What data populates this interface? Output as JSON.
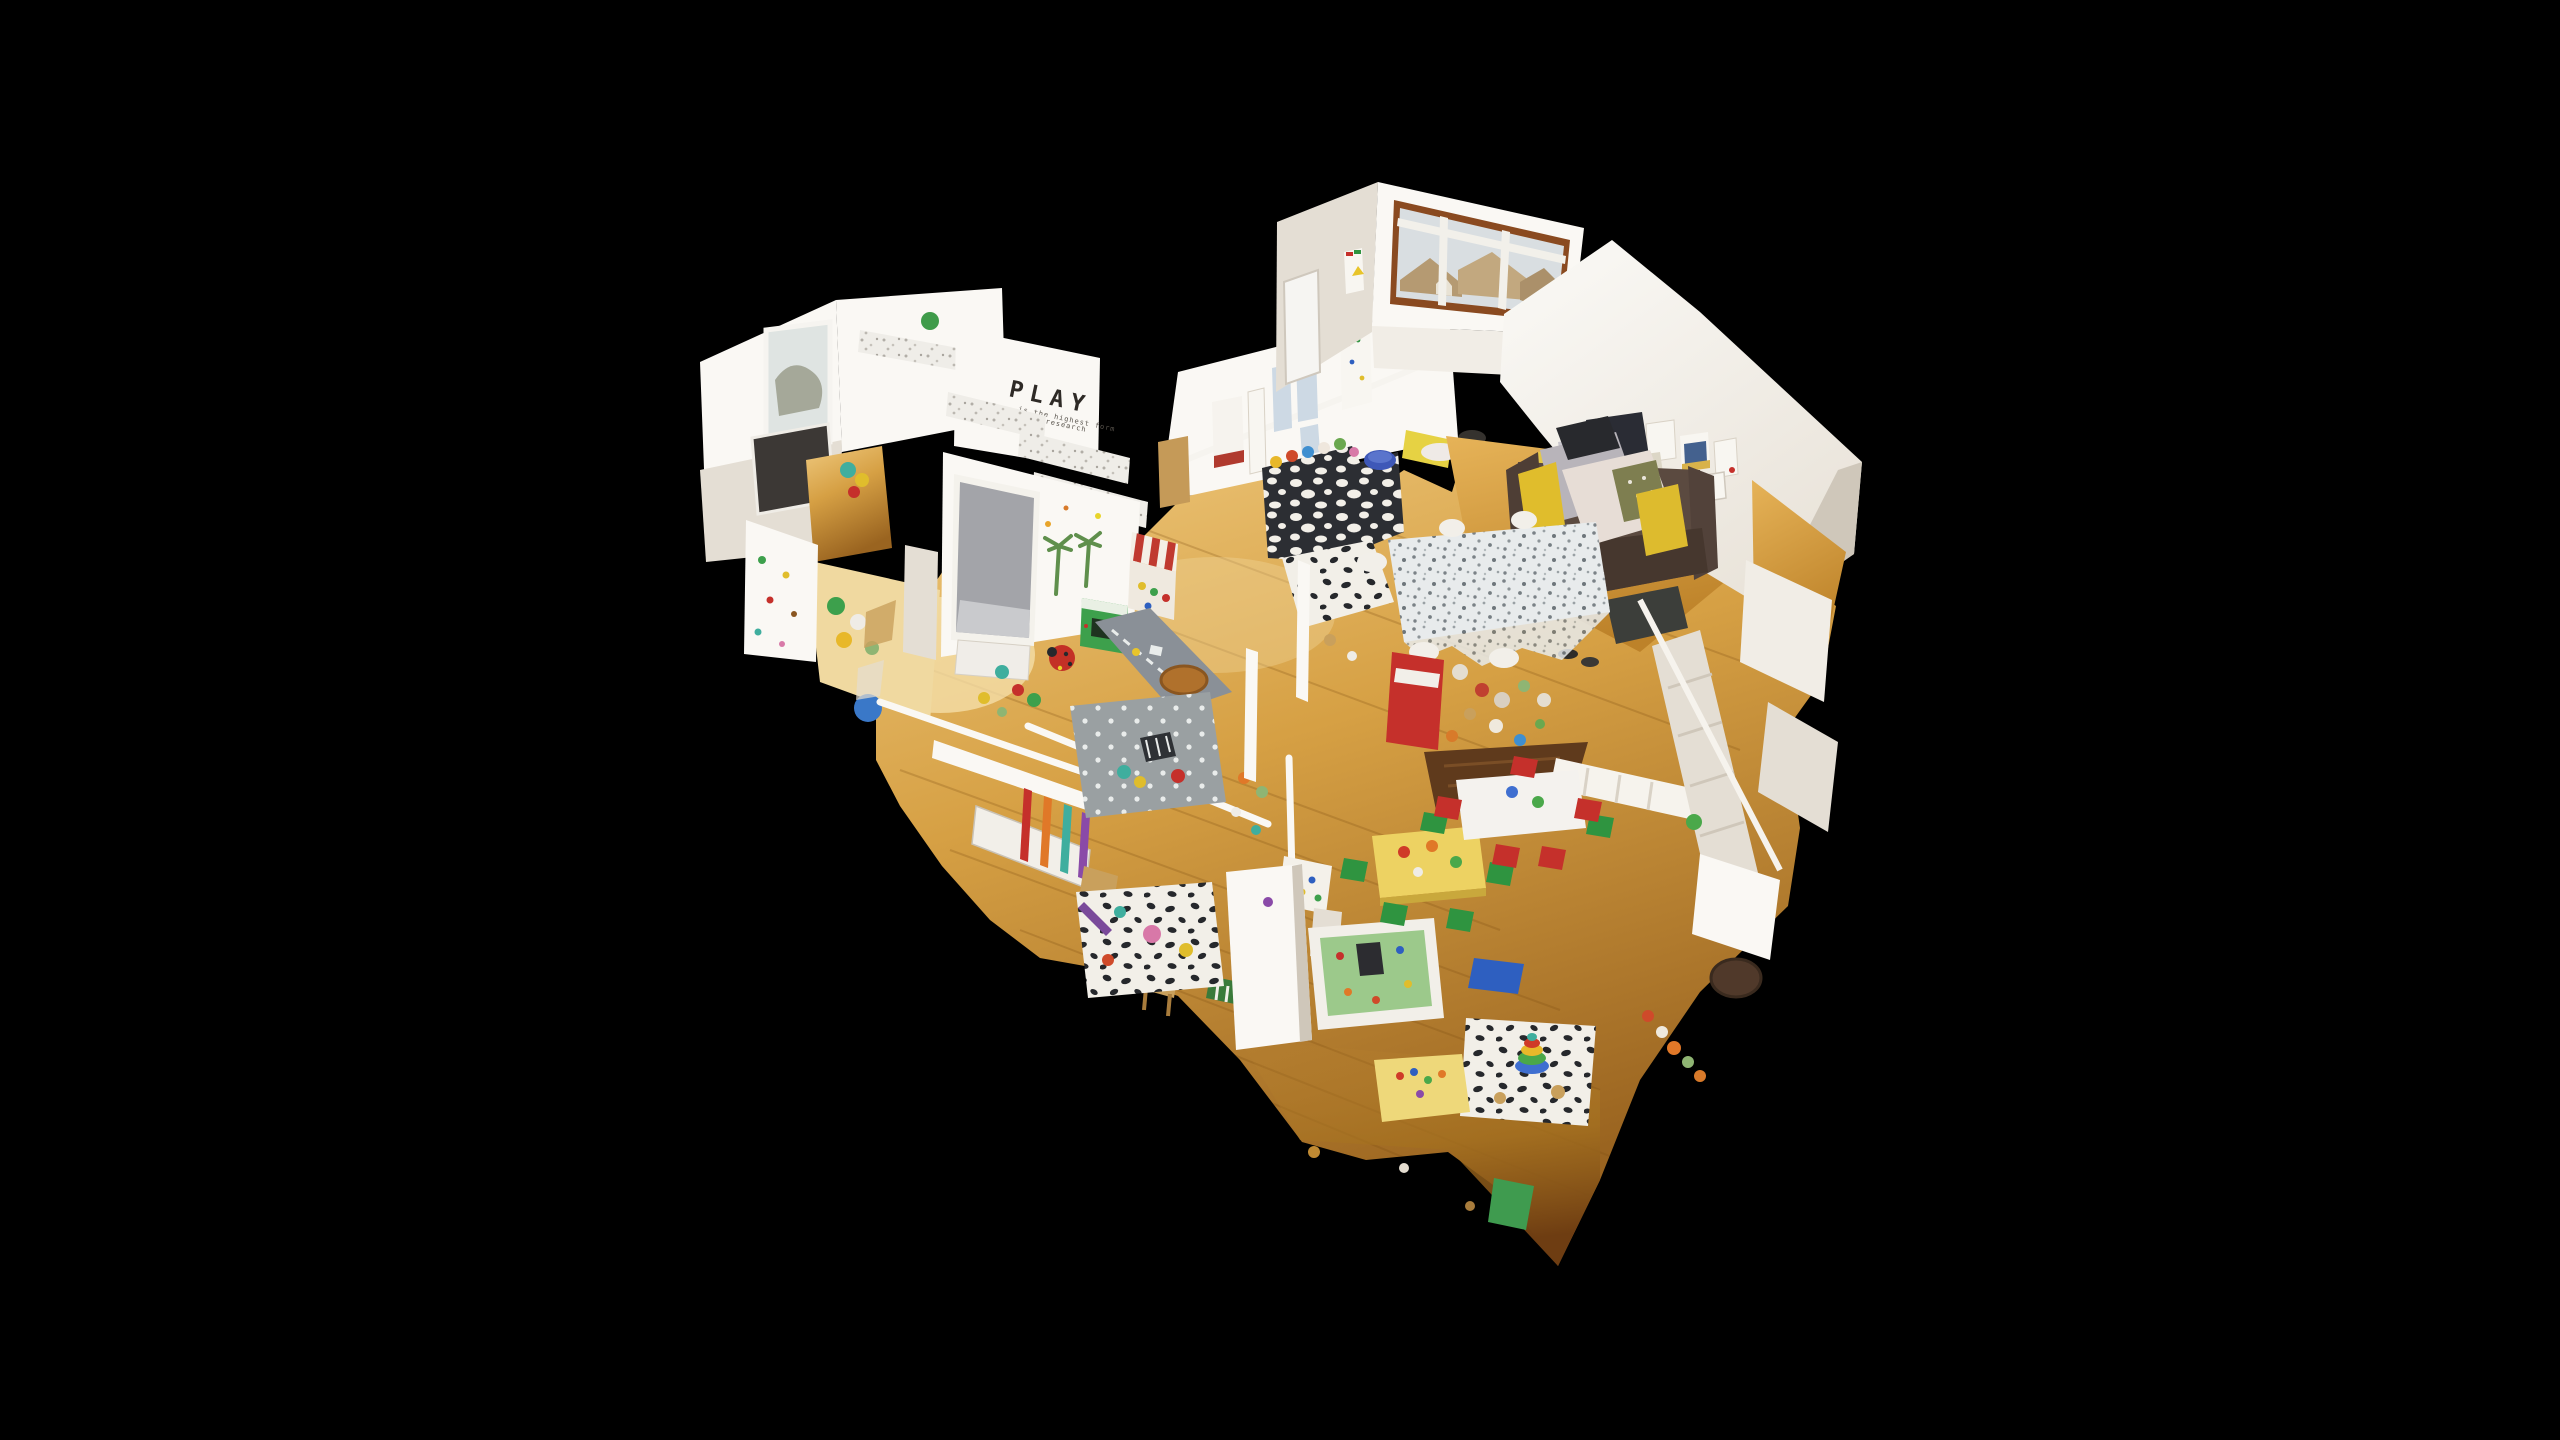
{
  "scene": {
    "type": "3d-dollhouse-scan",
    "subject": "Cutaway dollhouse view of a children's nursery playroom, floating on a black background",
    "background": "#000000",
    "wall_quote": {
      "title": "PLAY",
      "line1": "is the highest form",
      "line2": "of research"
    },
    "palette": {
      "background": "#000000",
      "wall": "#f1ede6",
      "wall_bright": "#faf8f4",
      "wall_shadow": "#e4ded4",
      "wall_dark": "#cfc7ba",
      "floor_light": "#efcb7e",
      "floor_mid": "#d29a3e",
      "floor_dark": "#9a6420",
      "floor_burnt": "#6e3d12",
      "floor_walnut": "#5f3a1c",
      "sky": "#d9dee1",
      "roof_tan": "#b59a72",
      "window_frame_brown": "#8a4a20",
      "blind_grey": "#a3a4a9",
      "sofa_brown": "#5b4a40",
      "sofa_dark": "#46372e",
      "pillow_yellow": "#e0bd2c",
      "pillow_olive": "#7e7e50",
      "blanket_grey": "#b8b4ba",
      "blanket_pink": "#e7ddd6",
      "rug_grey": "#8a9097",
      "rug_polka": "#9aa0a2",
      "spot_black": "#26282c",
      "canopy_red": "#c03a30",
      "toy_green": "#3da04c",
      "chair_green": "#2f9440",
      "chair_red": "#c5302b",
      "chair_blue": "#2e5fc0",
      "table_yellow": "#edd262",
      "table_pale_yellow": "#eed87a",
      "mat_green": "#9cc98b",
      "basket_brown": "#b0712c",
      "cork": "#c59a58",
      "poster_red": "#b03a2e",
      "paper_blue": "#cdd9e4"
    }
  }
}
